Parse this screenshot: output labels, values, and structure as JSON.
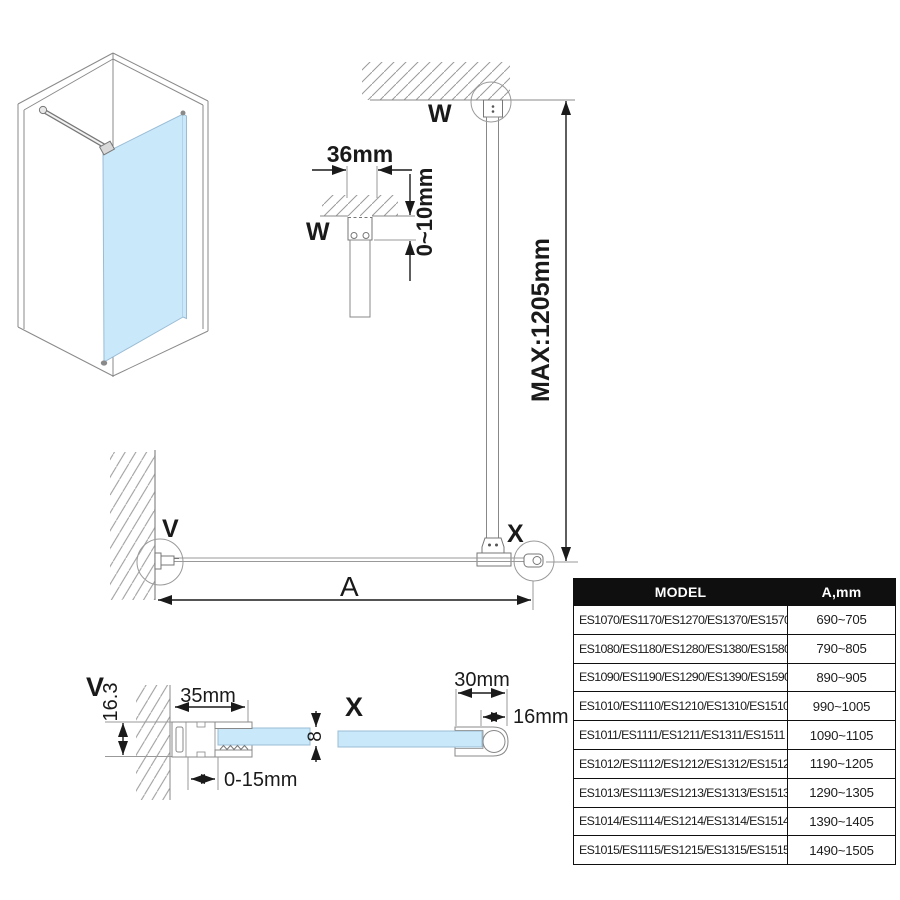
{
  "drawing": {
    "labels": {
      "detail_w": "W",
      "detail_v": "V",
      "detail_x": "X",
      "glass_width": "A"
    },
    "dimensions": {
      "bracket_width": "36mm",
      "ceiling_gap": "0~10mm",
      "max_bar_length": "MAX:1205mm",
      "wall_profile_height": "16.3",
      "wall_profile_width": "35mm",
      "wall_adjustment": "0-15mm",
      "glass_thickness": "8",
      "end_profile_width": "30mm",
      "end_profile_round": "16mm"
    },
    "colors": {
      "glass": "#C9E8FA",
      "line_gray": "#888888",
      "dimension_black": "#1a1a1a",
      "table_header_bg": "#0f0f0f",
      "table_header_fg": "#ffffff"
    }
  },
  "table": {
    "headers": [
      "MODEL",
      "A,mm"
    ],
    "rows": [
      {
        "model": "ES1070/ES1170/ES1270/ES1370/ES1570",
        "a_mm": "690~705"
      },
      {
        "model": "ES1080/ES1180/ES1280/ES1380/ES1580",
        "a_mm": "790~805"
      },
      {
        "model": "ES1090/ES1190/ES1290/ES1390/ES1590",
        "a_mm": "890~905"
      },
      {
        "model": "ES1010/ES1110/ES1210/ES1310/ES1510",
        "a_mm": "990~1005"
      },
      {
        "model": "ES1011/ES1111/ES1211/ES1311/ES1511",
        "a_mm": "1090~1105"
      },
      {
        "model": "ES1012/ES1112/ES1212/ES1312/ES1512",
        "a_mm": "1190~1205"
      },
      {
        "model": "ES1013/ES1113/ES1213/ES1313/ES1513",
        "a_mm": "1290~1305"
      },
      {
        "model": "ES1014/ES1114/ES1214/ES1314/ES1514",
        "a_mm": "1390~1405"
      },
      {
        "model": "ES1015/ES1115/ES1215/ES1315/ES1515",
        "a_mm": "1490~1505"
      }
    ]
  }
}
